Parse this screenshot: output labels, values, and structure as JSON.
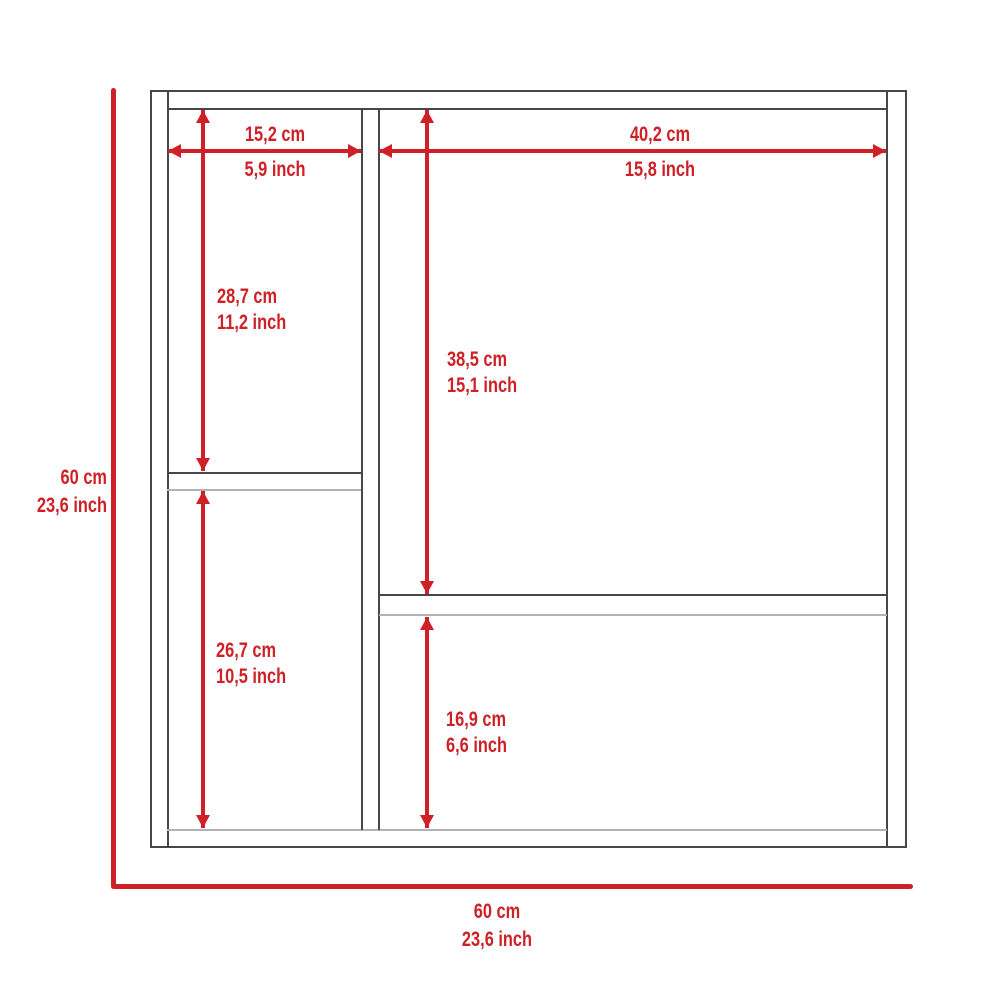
{
  "diagram": {
    "type": "furniture-dimension-drawing",
    "subject": "medicine-cabinet-front-view",
    "colors": {
      "accent": "#ce2127",
      "structure": "#474747",
      "structure_light": "#b2b2b2",
      "background": "#ffffff"
    },
    "dimensions": {
      "left_column_width": {
        "cm": "15,2 cm",
        "inch": "5,9 inch"
      },
      "right_column_width": {
        "cm": "40,2 cm",
        "inch": "15,8 inch"
      },
      "left_upper_compartment": {
        "cm": "28,7 cm",
        "inch": "11,2 inch"
      },
      "right_upper_compartment": {
        "cm": "38,5 cm",
        "inch": "15,1 inch"
      },
      "left_lower_compartment": {
        "cm": "26,7 cm",
        "inch": "10,5 inch"
      },
      "right_lower_compartment": {
        "cm": "16,9 cm",
        "inch": "6,6 inch"
      },
      "overall_height": {
        "cm": "60 cm",
        "inch": "23,6 inch"
      },
      "overall_width": {
        "cm": "60 cm",
        "inch": "23,6 inch"
      }
    }
  }
}
